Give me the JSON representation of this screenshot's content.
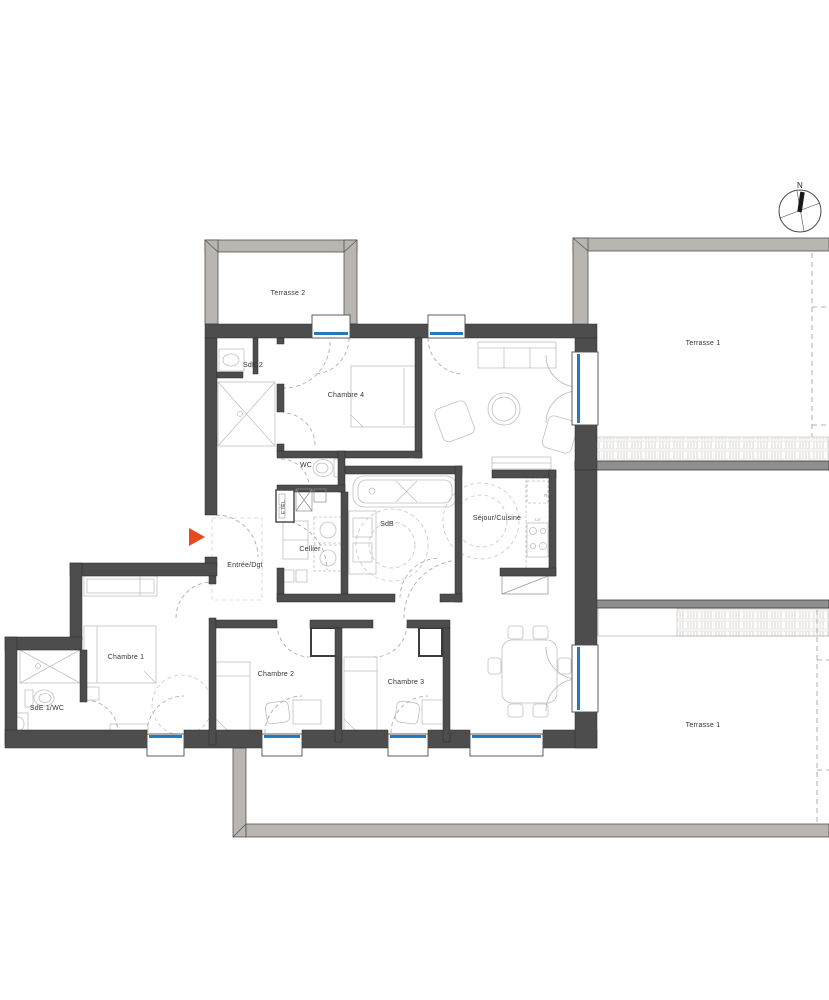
{
  "rooms": {
    "terrasse_2": "Terrasse 2",
    "terrasse_1_upper": "Terrasse 1",
    "terrasse_1_lower": "Terrasse 1",
    "sde_2": "SdE 2",
    "chambre_4": "Chambre 4",
    "wc": "WC",
    "sdb": "SdB",
    "sejour_cuisine": "Séjour/Cuisine",
    "cellier": "Cellier",
    "entree_dgt": "Entrée/Dgt",
    "chambre_1": "Chambre 1",
    "sde_1_wc": "SdE 1/WC",
    "chambre_2": "Chambre 2",
    "chambre_3": "Chambre 3"
  },
  "compass": {
    "north_label": "N"
  },
  "technical": {
    "etel": "ETEL",
    "lv": "LV",
    "fridge": "R"
  },
  "colors": {
    "wall": "#4d4d4d",
    "terrace_wall": "#b9b5b0",
    "divider_wall": "#8f8f8f",
    "glazing": "#2679bd",
    "entrance_arrow": "#e8491d",
    "hatch": "#d9d6d2",
    "furniture_line": "#c0c0c0"
  }
}
